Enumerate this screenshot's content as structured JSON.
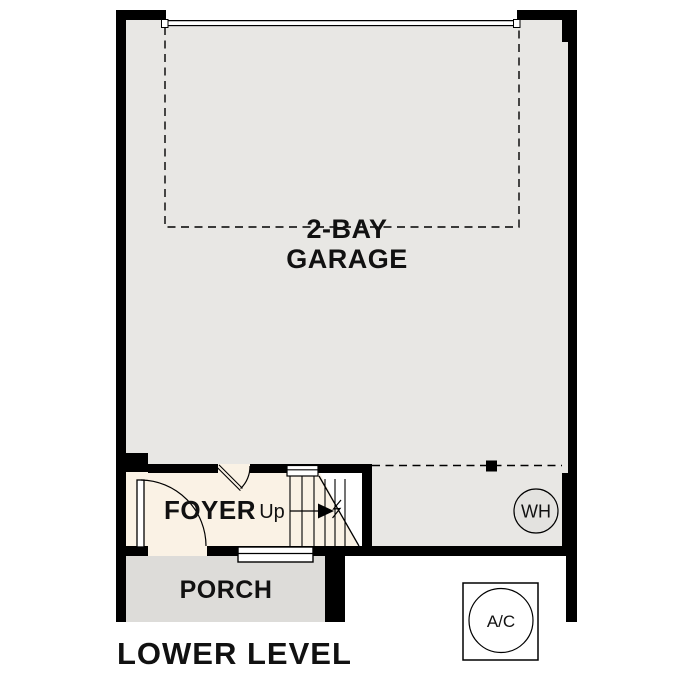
{
  "title": "LOWER LEVEL",
  "rooms": {
    "garage": {
      "label_line1": "2-BAY",
      "label_line2": "GARAGE"
    },
    "foyer": {
      "label": "FOYER"
    },
    "stairs": {
      "direction_label": "Up"
    },
    "porch": {
      "label": "PORCH"
    }
  },
  "equipment": {
    "water_heater": {
      "label": "WH"
    },
    "air_conditioner": {
      "label": "A/C"
    }
  },
  "colors": {
    "wall": "#000000",
    "garage_floor": "#e8e7e4",
    "utility_floor": "#e8e7e4",
    "foyer_floor": "#faf2e5",
    "porch_floor": "#dddcd9",
    "water_heater_fill": "#e3e2df",
    "stoop_fill": "#ffffff",
    "background": "#ffffff",
    "text": "#111111"
  }
}
